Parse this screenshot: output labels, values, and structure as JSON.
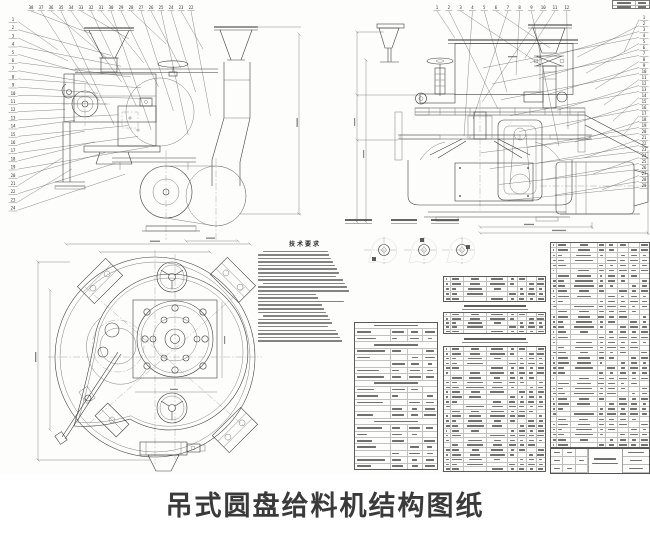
{
  "page": {
    "caption": "吊式圆盘给料机结构图纸"
  },
  "drawing": {
    "notes_title": "技术要求",
    "notes_line_count": 26,
    "callouts": {
      "left": 24,
      "top_left": 17,
      "top_right": 12,
      "right": 29
    },
    "detail_view_count": 3,
    "tables": {
      "spec": {
        "rows": 23
      },
      "parts_left_a": {
        "rows": 5
      },
      "parts_left_b": {
        "rows": 5
      },
      "parts_left_c": {
        "rows": 26
      },
      "parts_right": {
        "rows": 40
      }
    }
  }
}
